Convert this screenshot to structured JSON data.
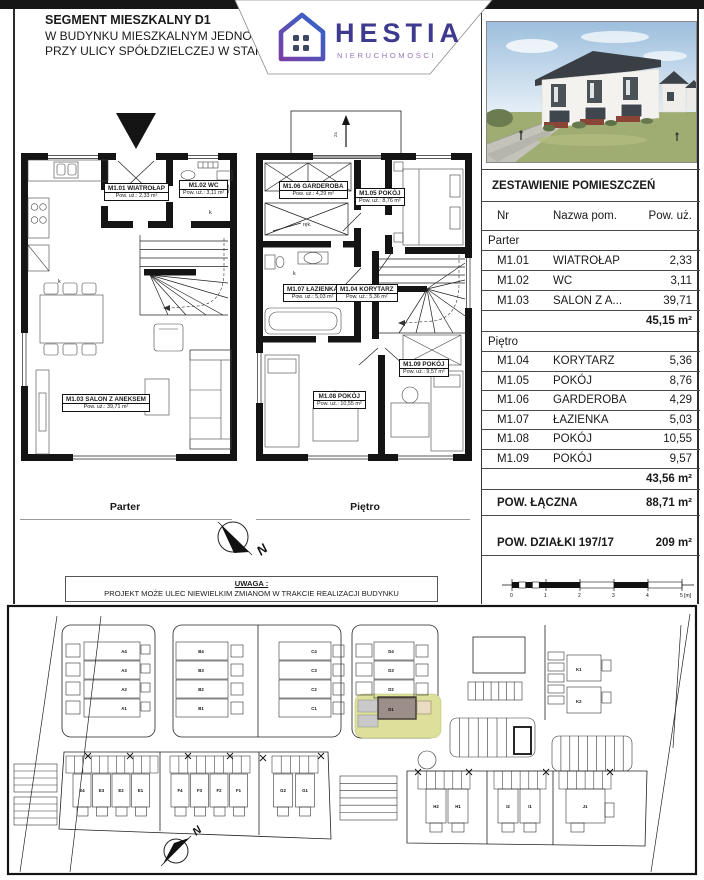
{
  "header": {
    "title": "SEGMENT MIESZKALNY D1",
    "line2": "W BUDYNKU MIESZKALNYM JEDNORODZ",
    "line3": "PRZY ULICY SPÓŁDZIELCZEJ W STARGARD"
  },
  "logo": {
    "name": "HESTIA",
    "tagline": "NIERUCHOMOŚCI",
    "accent_purple": "#7a3fa5",
    "accent_blue": "#2f66cc",
    "text_color": "#3e3a8e",
    "tagline_color": "#9b76ba"
  },
  "plans": {
    "parter": {
      "caption": "Parter",
      "rooms": [
        {
          "id": "M1.01 WIATROŁAP",
          "area": "Pow. uż.: 2,33 m²"
        },
        {
          "id": "M1.02 WC",
          "area": "Pow. uż.: 3,11 m²"
        },
        {
          "id": "M1.03 SALON Z ANEKSEM",
          "area": "Pow. uż.: 39,71 m²"
        }
      ]
    },
    "pietro": {
      "caption": "Piętro",
      "rooms": [
        {
          "id": "M1.06 GARDEROBA",
          "area": "Pow. uż.: 4,29 m²"
        },
        {
          "id": "M1.05 POKÓJ",
          "area": "Pow. uż.: 8,76 m²"
        },
        {
          "id": "M1.07 ŁAZIENKA",
          "area": "Pow. uż.: 5,03 m²"
        },
        {
          "id": "M1.04 KORYTARZ",
          "area": "Pow. uż.: 5,36 m²"
        },
        {
          "id": "M1.08 POKÓJ",
          "area": "Pow. uż.: 10,55 m²"
        },
        {
          "id": "M1.09 POKÓJ",
          "area": "Pow. uż.: 9,57 m²"
        }
      ]
    },
    "annotations": {
      "k": "k",
      "rek": "ręk.",
      "slope": "2x"
    }
  },
  "compass": {
    "label": "N"
  },
  "notice": {
    "title": "UWAGA :",
    "text": "PROJEKT MOŻE ULEC NIEWIELKIM ZMIANOM W TRAKCIE REALIZACJI BUDYNKU"
  },
  "schedule": {
    "title": "ZESTAWIENIE POMIESZCZEŃ",
    "columns": [
      "Nr",
      "Nazwa pom.",
      "Pow. uż."
    ],
    "sections": [
      {
        "label": "Parter",
        "rows": [
          {
            "id": "M1.01",
            "name": "WIATROŁAP",
            "val": "2,33"
          },
          {
            "id": "M1.02",
            "name": "WC",
            "val": "3,11"
          },
          {
            "id": "M1.03",
            "name": "SALON Z A...",
            "val": "39,71"
          }
        ],
        "subtotal": "45,15 m²"
      },
      {
        "label": "Piętro",
        "rows": [
          {
            "id": "M1.04",
            "name": "KORYTARZ",
            "val": "5,36"
          },
          {
            "id": "M1.05",
            "name": "POKÓJ",
            "val": "8,76"
          },
          {
            "id": "M1.06",
            "name": "GARDEROBA",
            "val": "4,29"
          },
          {
            "id": "M1.07",
            "name": "ŁAZIENKA",
            "val": "5,03"
          },
          {
            "id": "M1.08",
            "name": "POKÓJ",
            "val": "10,55"
          },
          {
            "id": "M1.09",
            "name": "POKÓJ",
            "val": "9,57"
          }
        ],
        "subtotal": "43,56 m²"
      }
    ],
    "total_label": "POW. ŁĄCZNA",
    "total_value": "88,71 m²",
    "plot_label": "POW. DZIAŁKI 197/17",
    "plot_value": "209 m²"
  },
  "scalebar": {
    "ticks": [
      "0",
      "1",
      "2",
      "3",
      "4",
      "5 [m]"
    ]
  },
  "siteplan": {
    "a": [
      "A4",
      "A3",
      "A2",
      "A1"
    ],
    "b": [
      "B4",
      "B3",
      "B2",
      "B1"
    ],
    "c": [
      "C4",
      "C3",
      "C2",
      "C1"
    ],
    "d": [
      "D4",
      "D3",
      "D2",
      "D1"
    ],
    "e": [
      "E4",
      "E3",
      "E2",
      "E1"
    ],
    "f": [
      "F4",
      "F3",
      "F2",
      "F1"
    ],
    "g": [
      "G2",
      "G1"
    ],
    "h": [
      "H2",
      "H1"
    ],
    "i": [
      "I2",
      "I1"
    ],
    "j": [
      "J1"
    ],
    "k": [
      "K1",
      "K2"
    ],
    "highlight_unit": "D1",
    "highlight_plot_color": "#dce09b",
    "highlight_building_color": "#9c8e88"
  }
}
